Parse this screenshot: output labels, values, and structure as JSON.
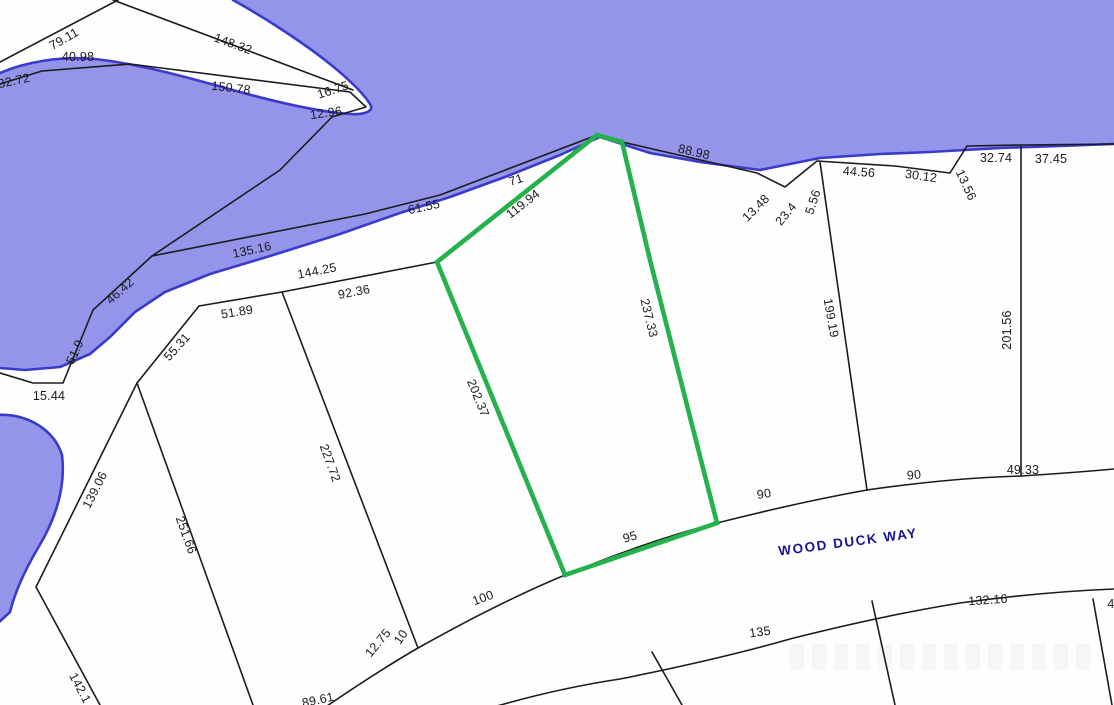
{
  "map": {
    "type": "plat-parcel-map",
    "street": {
      "name": "WOOD DUCK WAY",
      "x": 848,
      "y": 542
    },
    "highlighted_parcel": {
      "color": "#25b24c",
      "side_dimensions": [
        "119.94",
        "237.33",
        "95",
        "202.37",
        "71"
      ]
    },
    "colors": {
      "water": "#9394ea",
      "waterline": "#3a3acb",
      "land": "#fefefe",
      "line": "#1c1c1c",
      "parcel": "#25b24c",
      "label": "#1b1b1b",
      "street": "#15158d"
    },
    "labels": [
      {
        "t": "79.11",
        "x": 64,
        "y": 39,
        "r": -30
      },
      {
        "t": "148.32",
        "x": 233,
        "y": 44,
        "r": 20
      },
      {
        "t": "40.98",
        "x": 78,
        "y": 57,
        "r": 0
      },
      {
        "t": "32.72",
        "x": 14,
        "y": 81,
        "r": -12
      },
      {
        "t": "150.78",
        "x": 231,
        "y": 88,
        "r": 7
      },
      {
        "t": "16.75",
        "x": 333,
        "y": 90,
        "r": -18
      },
      {
        "t": "12.96",
        "x": 326,
        "y": 113,
        "r": -8
      },
      {
        "t": "71",
        "x": 516,
        "y": 180,
        "r": -18
      },
      {
        "t": "61.55",
        "x": 424,
        "y": 207,
        "r": -12
      },
      {
        "t": "119.94",
        "x": 523,
        "y": 204,
        "r": -38
      },
      {
        "t": "88.98",
        "x": 694,
        "y": 152,
        "r": 13
      },
      {
        "t": "135.16",
        "x": 252,
        "y": 250,
        "r": -12
      },
      {
        "t": "144.25",
        "x": 317,
        "y": 271,
        "r": -11
      },
      {
        "t": "92.36",
        "x": 354,
        "y": 292,
        "r": -11
      },
      {
        "t": "51.89",
        "x": 237,
        "y": 312,
        "r": -9
      },
      {
        "t": "46.42",
        "x": 120,
        "y": 291,
        "r": -42
      },
      {
        "t": "51.9",
        "x": 75,
        "y": 352,
        "r": -65
      },
      {
        "t": "55.31",
        "x": 177,
        "y": 347,
        "r": -48
      },
      {
        "t": "15.44",
        "x": 49,
        "y": 396,
        "r": 0
      },
      {
        "t": "13.48",
        "x": 756,
        "y": 208,
        "r": -45
      },
      {
        "t": "23.4",
        "x": 786,
        "y": 214,
        "r": -50
      },
      {
        "t": "5.56",
        "x": 813,
        "y": 202,
        "r": -72
      },
      {
        "t": "44.56",
        "x": 859,
        "y": 172,
        "r": 4
      },
      {
        "t": "30.12",
        "x": 921,
        "y": 176,
        "r": 8
      },
      {
        "t": "13.56",
        "x": 966,
        "y": 185,
        "r": 65
      },
      {
        "t": "32.74",
        "x": 996,
        "y": 158,
        "r": 0
      },
      {
        "t": "37.45",
        "x": 1051,
        "y": 159,
        "r": 0
      },
      {
        "t": "199.19",
        "x": 831,
        "y": 318,
        "r": 80
      },
      {
        "t": "201.56",
        "x": 1007,
        "y": 330,
        "r": -90
      },
      {
        "t": "237.33",
        "x": 649,
        "y": 318,
        "r": 76
      },
      {
        "t": "202.37",
        "x": 478,
        "y": 398,
        "r": 68
      },
      {
        "t": "227.72",
        "x": 330,
        "y": 463,
        "r": 70
      },
      {
        "t": "139.06",
        "x": 95,
        "y": 490,
        "r": -63
      },
      {
        "t": "251.66",
        "x": 186,
        "y": 535,
        "r": 70
      },
      {
        "t": "142.1",
        "x": 80,
        "y": 688,
        "r": 62
      },
      {
        "t": "12.75",
        "x": 378,
        "y": 643,
        "r": -50
      },
      {
        "t": "10",
        "x": 401,
        "y": 637,
        "r": -55
      },
      {
        "t": "100",
        "x": 483,
        "y": 598,
        "r": -20
      },
      {
        "t": "95",
        "x": 630,
        "y": 537,
        "r": -17
      },
      {
        "t": "90",
        "x": 764,
        "y": 494,
        "r": -10
      },
      {
        "t": "90",
        "x": 914,
        "y": 475,
        "r": -5
      },
      {
        "t": "49.33",
        "x": 1023,
        "y": 470,
        "r": 0
      },
      {
        "t": "135",
        "x": 760,
        "y": 632,
        "r": -8
      },
      {
        "t": "132.16",
        "x": 988,
        "y": 600,
        "r": -4
      },
      {
        "t": "89.61",
        "x": 318,
        "y": 700,
        "r": -12
      },
      {
        "t": "4",
        "x": 1111,
        "y": 604,
        "r": 0
      }
    ]
  }
}
